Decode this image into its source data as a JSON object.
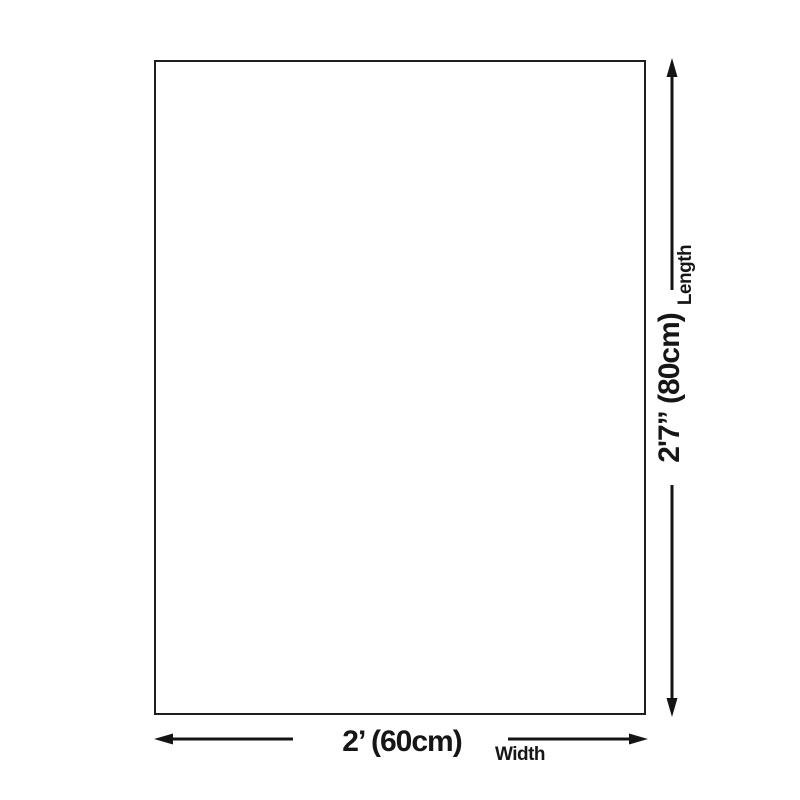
{
  "diagram": {
    "background_color": "#ffffff",
    "ink_color": "#161616",
    "length": {
      "label": "Length",
      "value": "2'7” (80cm)"
    },
    "width": {
      "label": "Width",
      "value": "2’ (60cm)"
    }
  }
}
